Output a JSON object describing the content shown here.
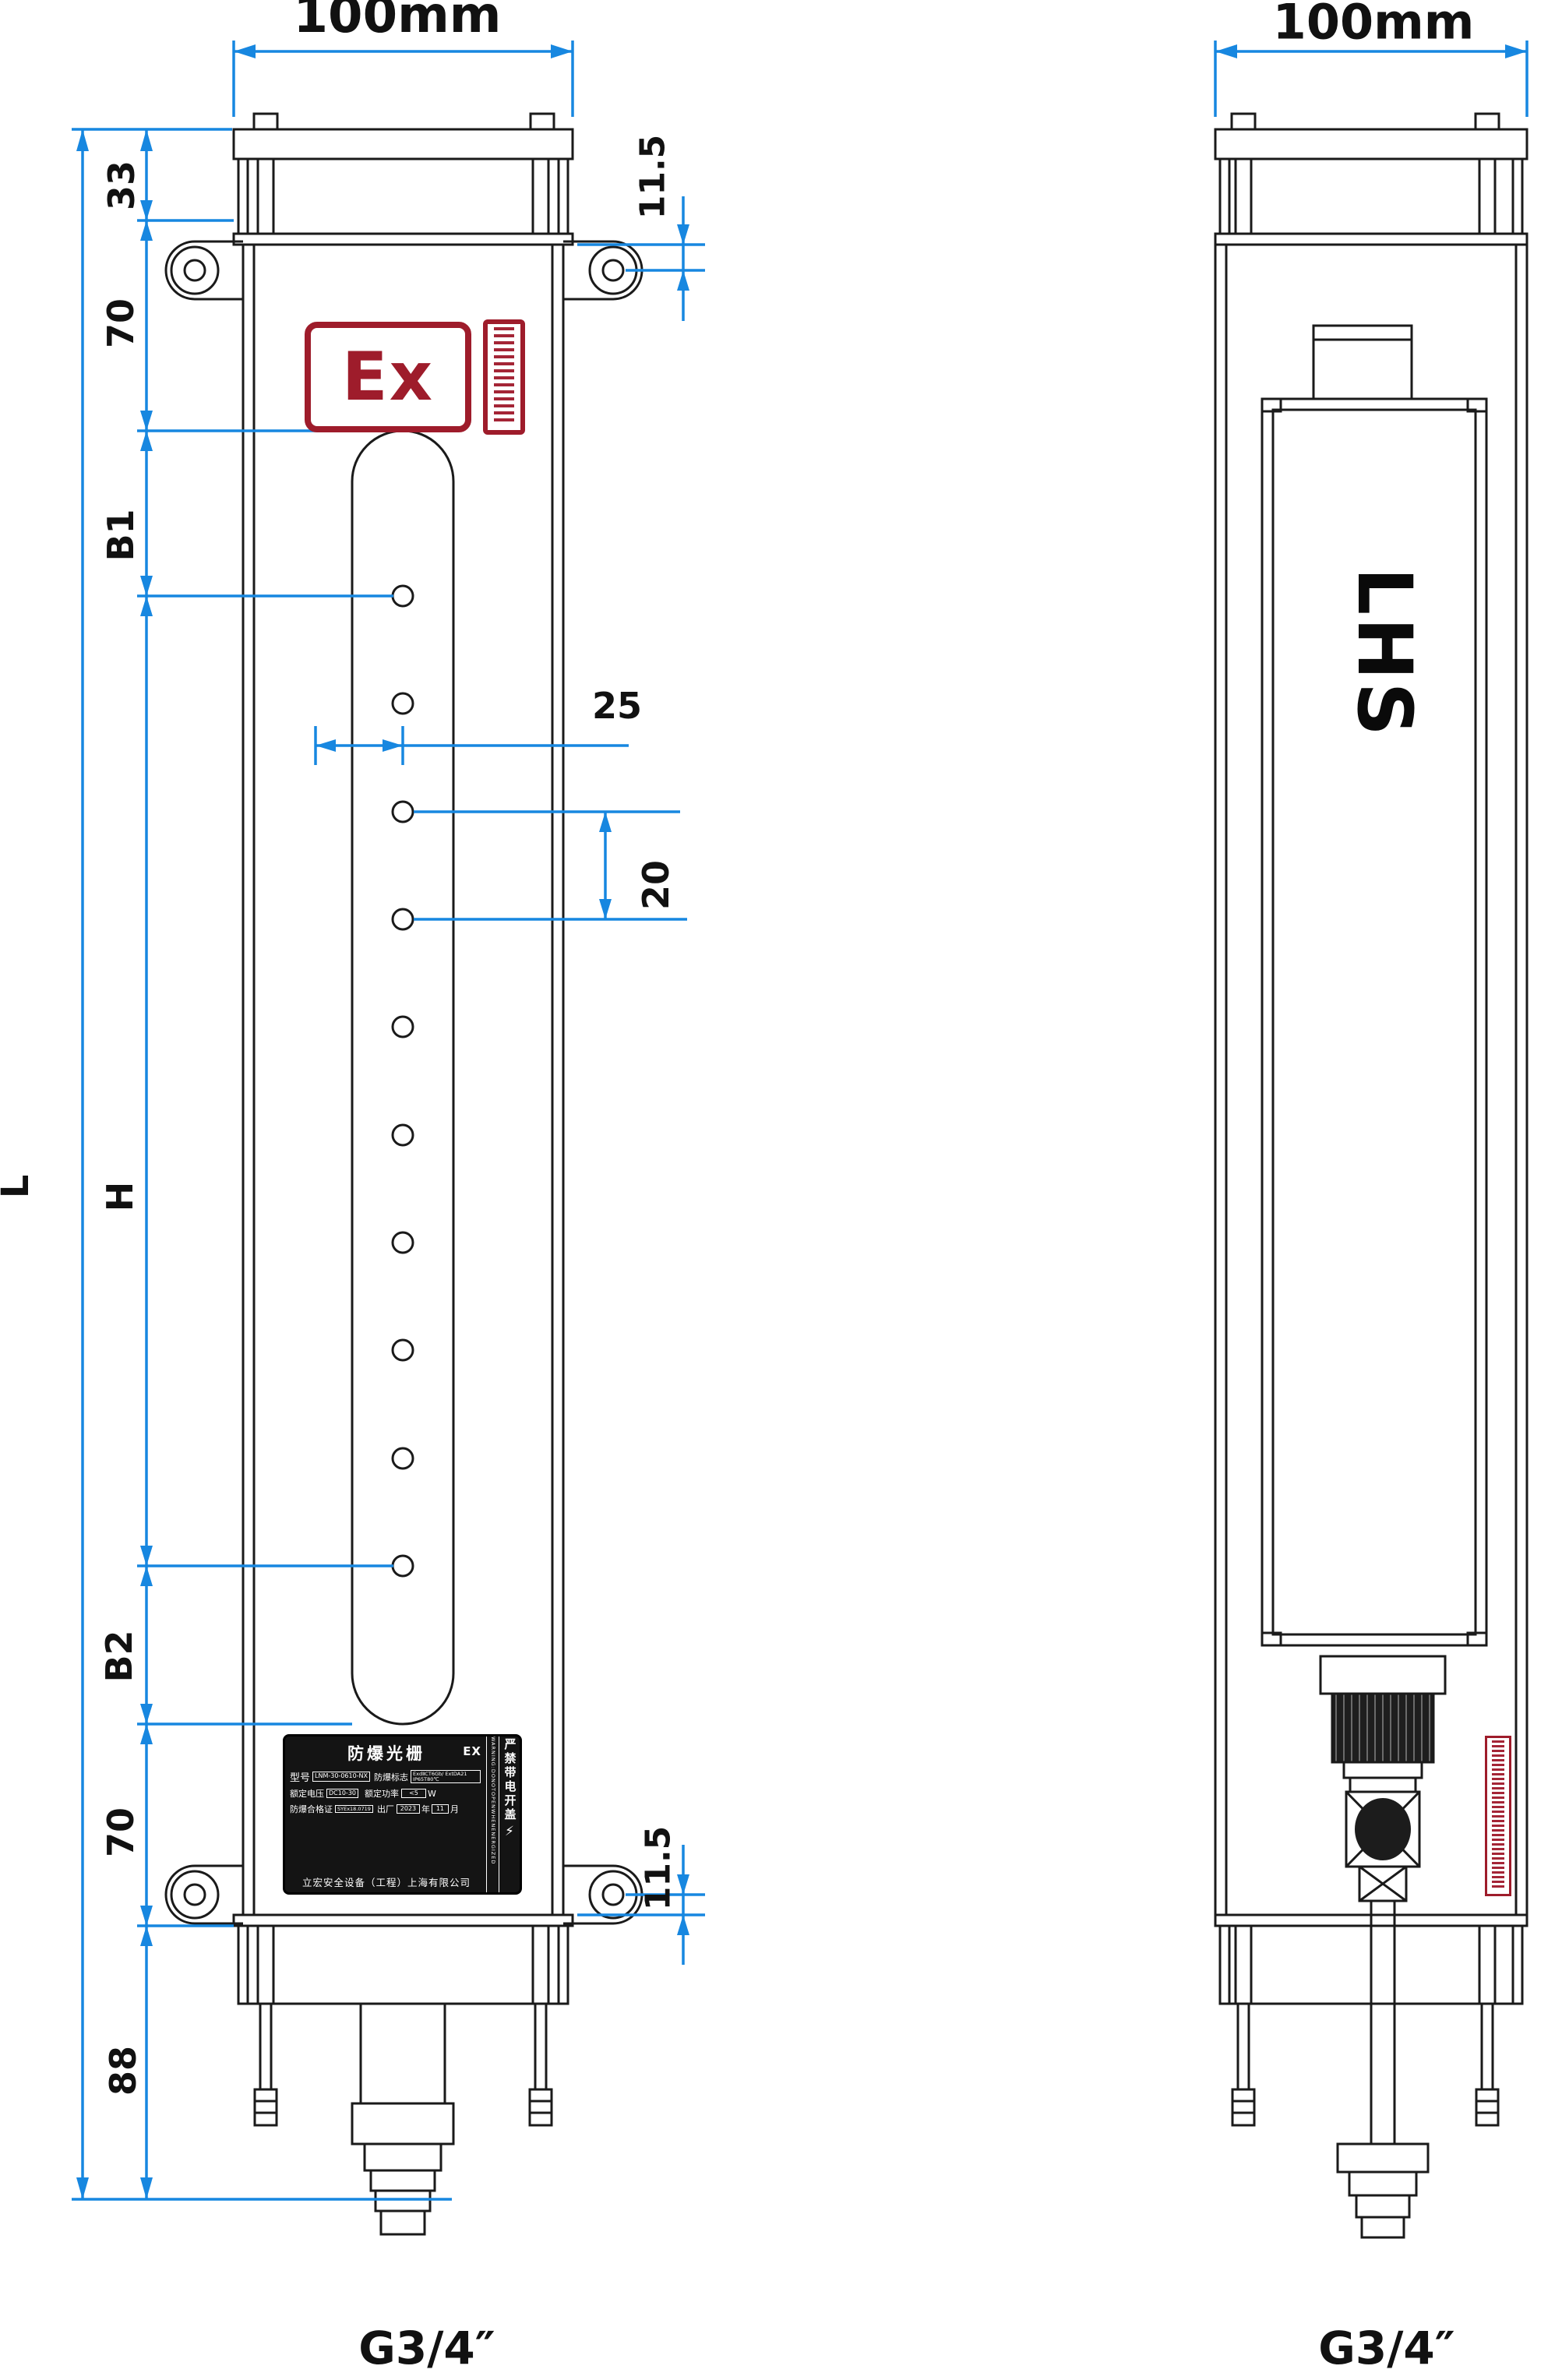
{
  "drawing": {
    "front_view": {
      "width_dim": "100mm",
      "overall_length_label": "L",
      "chain_dims": {
        "top_cap": "33",
        "upper_section": "70",
        "first_beam_offset": "B1",
        "protective_height": "H",
        "last_beam_offset": "B2",
        "lower_section": "70",
        "bottom_section": "88"
      },
      "bracket_hole_offset_top": "11.5",
      "bracket_hole_offset_bottom": "11.5",
      "beam_center_offset": "25",
      "beam_pitch": "20",
      "thread_spec": "G3/4″",
      "ex_mark": "Ex"
    },
    "side_view": {
      "width_dim": "100mm",
      "brand_logo": "LHS",
      "thread_spec": "G3/4″"
    },
    "nameplate": {
      "title": "防爆光栅",
      "title_suffix": "EX",
      "model_label": "型号",
      "model_value": "LNM-30-0610-NX",
      "exmark_label": "防爆标志",
      "exmark_value": "ExdⅡCT6Gb/ ExtDA21 IP65T80℃",
      "voltage_label": "额定电压",
      "voltage_value": "DC10-30",
      "power_label": "额定功率",
      "power_value": "<5",
      "power_unit": "W",
      "cert_label": "防爆合格证",
      "cert_value": "SYEx18.0719",
      "date_label": "出厂",
      "date_year": "2023",
      "year_unit": "年",
      "date_month": "11",
      "month_unit": "月",
      "company": "立宏安全设备（工程）上海有限公司",
      "warning_en": "WARNING:DONOTOPENWHENENERGIZED",
      "warning_cn": "严禁带电开盖",
      "bolt_icon": "⚡"
    },
    "colors": {
      "dimension_blue": "#1787e0",
      "drawing_black": "#1a1a1a",
      "brand_red": "#9e1c2b"
    }
  }
}
